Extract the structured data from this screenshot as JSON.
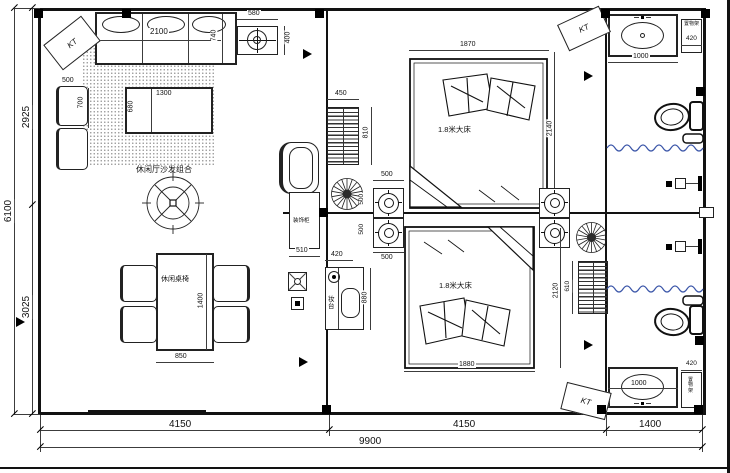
{
  "labels": {
    "kt": "KT",
    "sofa_group": "休闲厅沙发组合",
    "dining_set": "休闲桌椅",
    "bed": "1.8米大床",
    "deco_cabinet": "装饰柜",
    "dressing_table": "妆台",
    "shelf_unit": "置物架"
  },
  "dims": {
    "total_width": "9900",
    "span_left": "4150",
    "span_mid": "4150",
    "span_right": "1400",
    "total_height": "6100",
    "height_top": "2925",
    "height_bottom": "3025",
    "sofa_width": "2100",
    "sofa_depth": "740",
    "unit_top_width": "580",
    "unit_top_depth": "400",
    "armchair_width": "500",
    "armchair_depth": "700",
    "coffee_table_width": "1300",
    "coffee_table_depth": "680",
    "rack_width": "450",
    "rack_height": "810",
    "bed1_width": "1870",
    "bed1_length": "2140",
    "bed2_width": "1880",
    "bed2_length": "2120",
    "stove_width": "500",
    "cabinet_width": "510",
    "dresser_width": "420",
    "dresser_length": "880",
    "dining_width": "850",
    "dining_length": "1400",
    "rack2_height": "610",
    "basin_width": "1000",
    "shelf_width": "420"
  },
  "colors": {
    "wall": "#121212",
    "wave_line": "#3a55a8"
  }
}
